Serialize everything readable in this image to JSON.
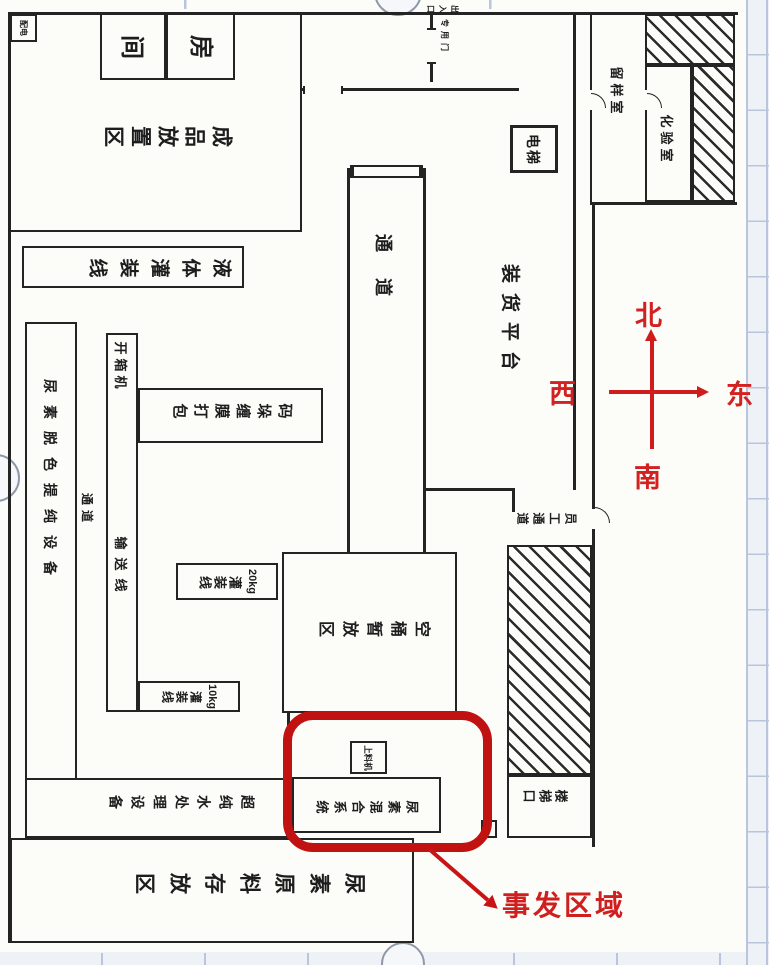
{
  "annotations": {
    "north": "北",
    "south": "南",
    "east": "东",
    "west": "西",
    "incident_area": "事发区域",
    "highlight_color": "#c11212",
    "annotation_red": "#d32020"
  },
  "labels": {
    "power_box": "配电",
    "room_left": "间",
    "room_right": "房",
    "finished_goods_area": "成品放置区",
    "liquid_filling_line": "液体灌装线",
    "urea_decolor_equipment": "尿素脱色提纯设备",
    "corridor_small": "通道",
    "unboxing_machine": "开箱机",
    "conveyor_line": "输送线",
    "palletize_wrap_pack": "码垛缠膜打包",
    "weight_20kg": "20kg",
    "weight_10kg": "10kg",
    "filling_line": "灌装线",
    "empty_barrel_area": "空桶暂放区",
    "corridor_main": "通道",
    "loading_platform": "装货平台",
    "elevator": "电梯",
    "sample_room": "留样室",
    "laboratory": "化验室",
    "staff_passage": "员工通道",
    "stair_exit": "楼梯口",
    "feeder_machine": "上料机",
    "urea_mixing_system": "尿素混合系统",
    "pure_water_equipment": "超纯水处理设备",
    "urea_material_storage": "尿素原料存放区",
    "special_door": "专用门",
    "entrance_exit": "出入口"
  }
}
